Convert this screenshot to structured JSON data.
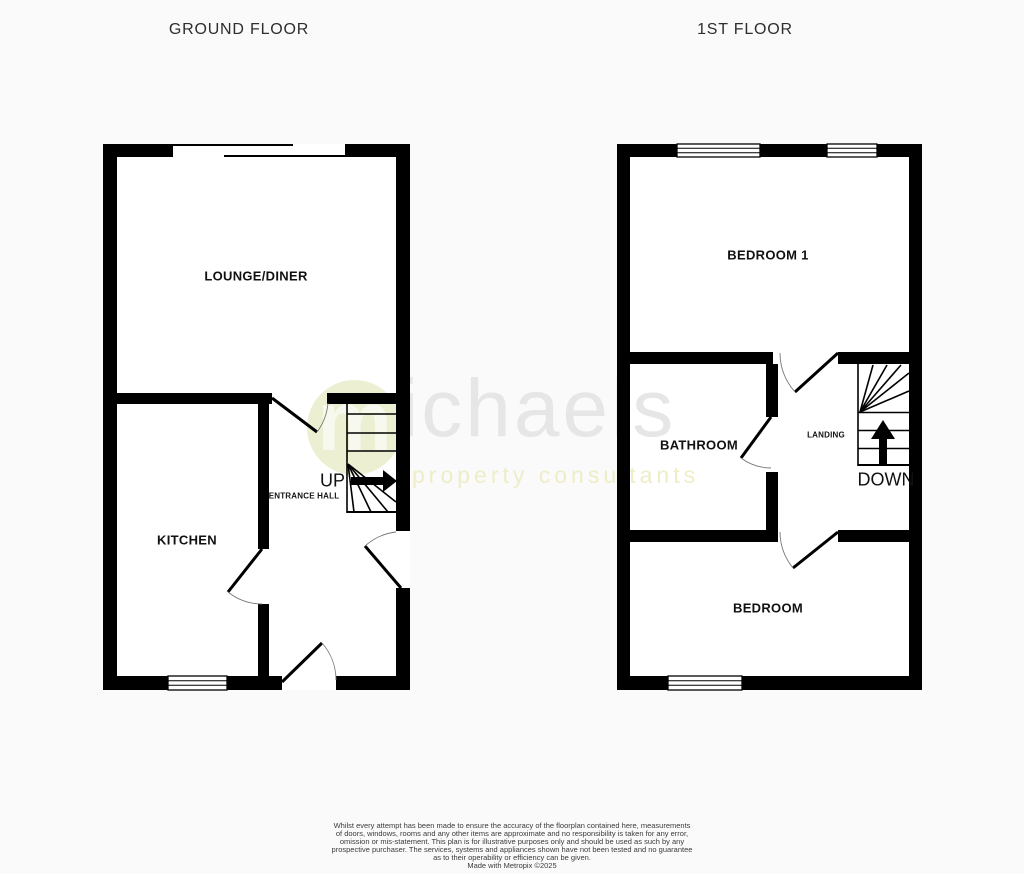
{
  "titles": {
    "ground_floor": "GROUND FLOOR",
    "first_floor": "1ST FLOOR"
  },
  "ground_floor": {
    "lounge_label": "LOUNGE/DINER",
    "kitchen_label": "KITCHEN",
    "hall_label": "ENTRANCE HALL",
    "up_label": "UP"
  },
  "first_floor": {
    "bedroom1_label": "BEDROOM 1",
    "bathroom_label": "BATHROOM",
    "landing_label": "LANDING",
    "bedroom2_label": "BEDROOM",
    "down_label": "DOWN"
  },
  "watermark": {
    "logo_letter": "m",
    "name": "ichaels",
    "tagline": "property consultants",
    "circle_color": "#edefd3",
    "name_color": "#e6e6e6",
    "tagline_color": "#efedc6"
  },
  "disclaimer": {
    "lines": [
      "Whilst every attempt has been made to ensure the accuracy of the floorplan contained here, measurements",
      "of doors, windows, rooms and any other items are approximate and no responsibility is taken for any error,",
      "omission or mis-statement. This plan is for illustrative purposes only and should be used as such by any",
      "prospective purchaser. The services, systems and appliances shown have not been tested and no guarantee",
      "as to their operability or efficiency can be given.",
      "Made with Metropix ©2025"
    ]
  },
  "colors": {
    "wall": "#000000",
    "background": "#fafafa",
    "floor_interior": "#ffffff"
  }
}
